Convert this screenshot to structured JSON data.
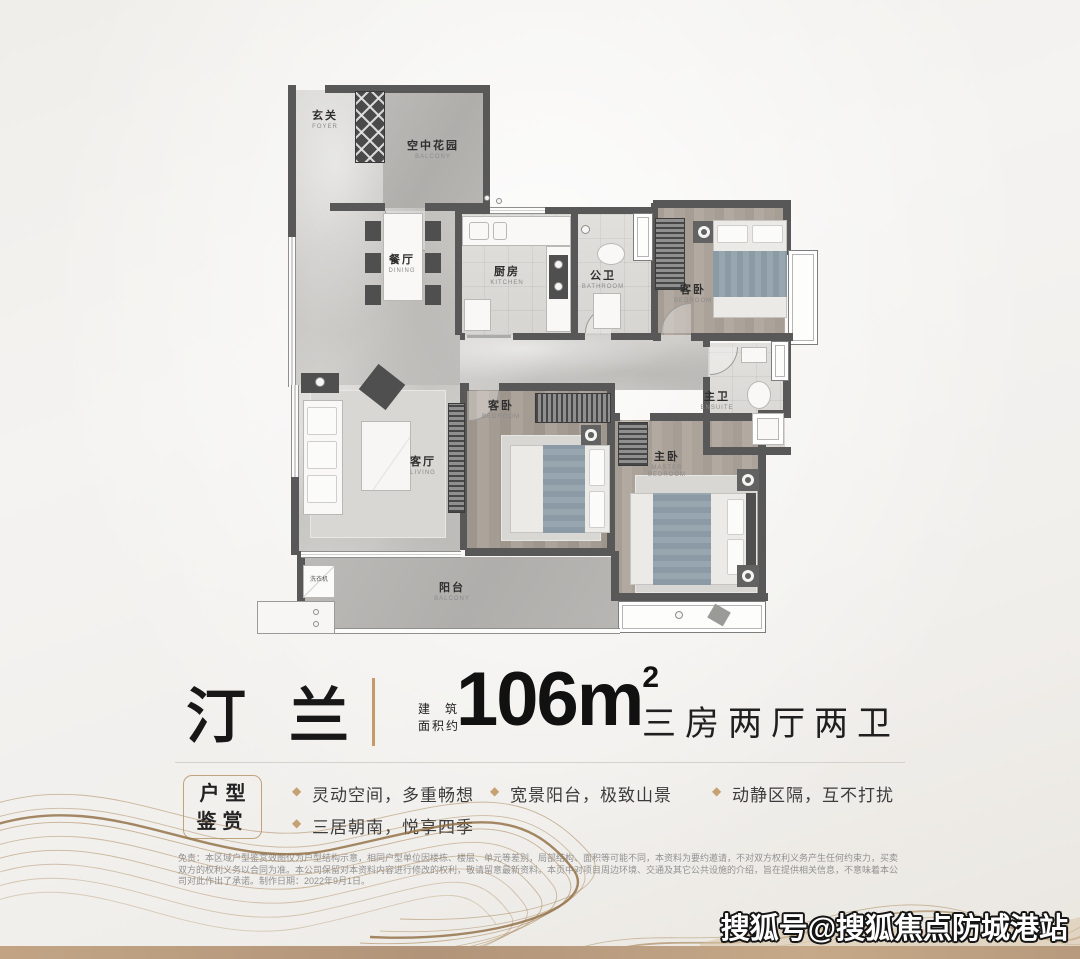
{
  "header": {
    "project_name": "汀 兰",
    "area_label_line1": "建筑",
    "area_label_line2": "面积约",
    "area_value": "106m",
    "area_sup": "2",
    "layout_text": "三房两厅两卫"
  },
  "badge": {
    "line1": "户型",
    "line2": "鉴赏"
  },
  "features": {
    "bullet_icon": "◆",
    "col1": [
      {
        "text": "灵动空间，多重畅想"
      },
      {
        "text": "三居朝南，悦享四季"
      }
    ],
    "col2": [
      {
        "text": "宽景阳台，极致山景"
      }
    ],
    "col3": [
      {
        "text": "动静区隔，互不打扰"
      }
    ]
  },
  "disclaimer": "免责：本区域户型鉴赏效图仅为户型结构示意，相同户型单位因楼栋、楼层、单元等差别，局部结构、面积等可能不同，本资料为要约邀请，不对双方权利义务产生任何约束力，买卖双方的权利义务以合同为准。本公司保留对本资料内容进行修改的权利，敬请留意最新资料。本页中对项目周边环境、交通及其它公共设施的介绍，旨在提供相关信息，不意味着本公司对此作出了承诺。制作日期：2022年9月1日。",
  "watermark": "搜狐号@搜狐焦点防城港站",
  "plan": {
    "rooms": {
      "foyer": {
        "name": "玄关",
        "en": "FOYER"
      },
      "sky_garden": {
        "name": "空中花园",
        "en": "BALCONY"
      },
      "dining": {
        "name": "餐厅",
        "en": "DINING"
      },
      "kitchen": {
        "name": "厨房",
        "en": "KITCHEN"
      },
      "bath": {
        "name": "公卫",
        "en": "BATHROOM"
      },
      "bedroom1": {
        "name": "客卧",
        "en": "BEDROOM"
      },
      "ensuite": {
        "name": "主卫",
        "en": "ENSUITE"
      },
      "living": {
        "name": "客厅",
        "en": "LIVING"
      },
      "bedroom2": {
        "name": "客卧",
        "en": "BEDROOM"
      },
      "master": {
        "name": "主卧",
        "en": "MASTER BEDROOM"
      },
      "balcony": {
        "name": "阳台",
        "en": "BALCONY"
      }
    },
    "washer_label": "洗衣机"
  },
  "colors": {
    "gold": "#c49a67",
    "wall": "#585858",
    "tan_strip": "#b79a7d"
  }
}
